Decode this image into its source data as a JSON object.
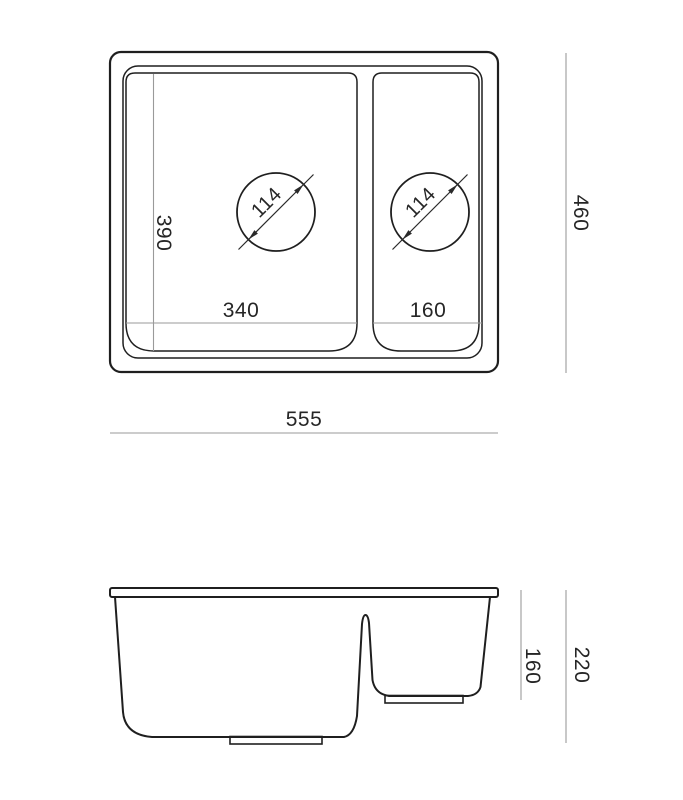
{
  "dimensions": {
    "top_view": {
      "main_bowl_drain_diameter": "114",
      "second_bowl_drain_diameter": "114",
      "main_bowl_depth": "390",
      "main_bowl_width": "340",
      "second_bowl_width": "160",
      "overall_depth": "460",
      "overall_width": "555"
    },
    "side_view": {
      "second_bowl_height": "160",
      "overall_height": "220"
    }
  },
  "colors": {
    "outline": "#1f1f1f",
    "dimension_line": "#9a9a9a",
    "text": "#262626",
    "background": "#ffffff"
  }
}
